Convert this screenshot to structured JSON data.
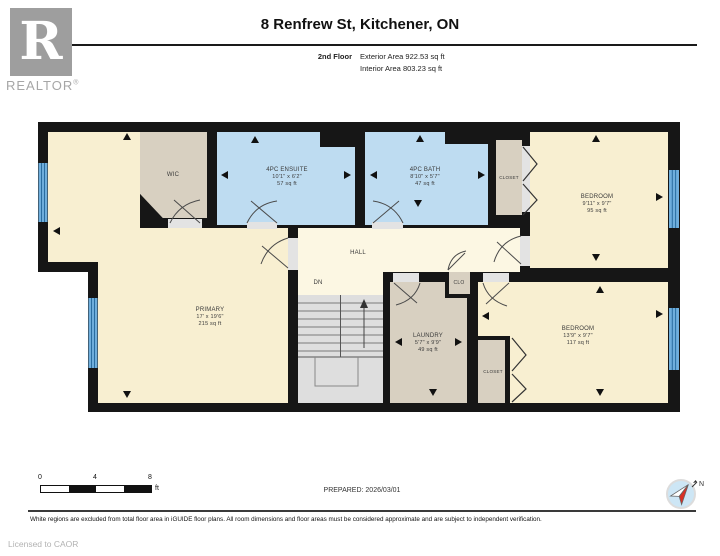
{
  "header": {
    "title": "8 Renfrew St, Kitchener, ON",
    "floor_label": "2nd Floor",
    "exterior_area": "Exterior Area 922.53 sq ft",
    "interior_area": "Interior Area 803.23 sq ft",
    "logo_letter": "R",
    "logo_brand": "REALTOR",
    "logo_reg": "®"
  },
  "rooms": {
    "primary": {
      "name": "PRIMARY",
      "dims": "17' x 19'6\"",
      "area": "215 sq ft"
    },
    "wic": {
      "name": "WIC"
    },
    "ensuite": {
      "name": "4PC ENSUITE",
      "dims": "10'1\" x 6'2\"",
      "area": "57 sq ft"
    },
    "bath": {
      "name": "4PC BATH",
      "dims": "8'10\" x 5'7\"",
      "area": "47 sq ft"
    },
    "closet_top": {
      "name": "CLOSET"
    },
    "bedroom1": {
      "name": "BEDROOM",
      "dims": "9'11\" x 9'7\"",
      "area": "95 sq ft"
    },
    "hall": {
      "name": "HALL"
    },
    "stairs": {
      "name": "DN"
    },
    "clo": {
      "name": "CLO"
    },
    "laundry": {
      "name": "LAUNDRY",
      "dims": "5'7\" x 9'9\"",
      "area": "49 sq ft"
    },
    "closet_bottom": {
      "name": "CLOSET"
    },
    "bedroom2": {
      "name": "BEDROOM",
      "dims": "13'9\" x 9'7\"",
      "area": "117 sq ft"
    }
  },
  "scale_bar": {
    "t0": "0",
    "t4": "4",
    "t8": "8",
    "unit": "ft"
  },
  "footer": {
    "prepared": "PREPARED: 2026/03/01",
    "compass_n": "N",
    "disclaimer": "White regions are excluded from total floor area in iGUIDE floor plans. All room dimensions and floor areas must be considered approximate and are subject to independent verification.",
    "licensed": "Licensed to CAOR"
  },
  "colors": {
    "wall": "#161616",
    "room_cream": "#f8efd1",
    "hall_pale": "#fcf7e3",
    "bath_blue": "#bedcf1",
    "closet_tan": "#d8d0c1",
    "stairs_gray": "#dedede",
    "window_blue": "#6faedc"
  }
}
